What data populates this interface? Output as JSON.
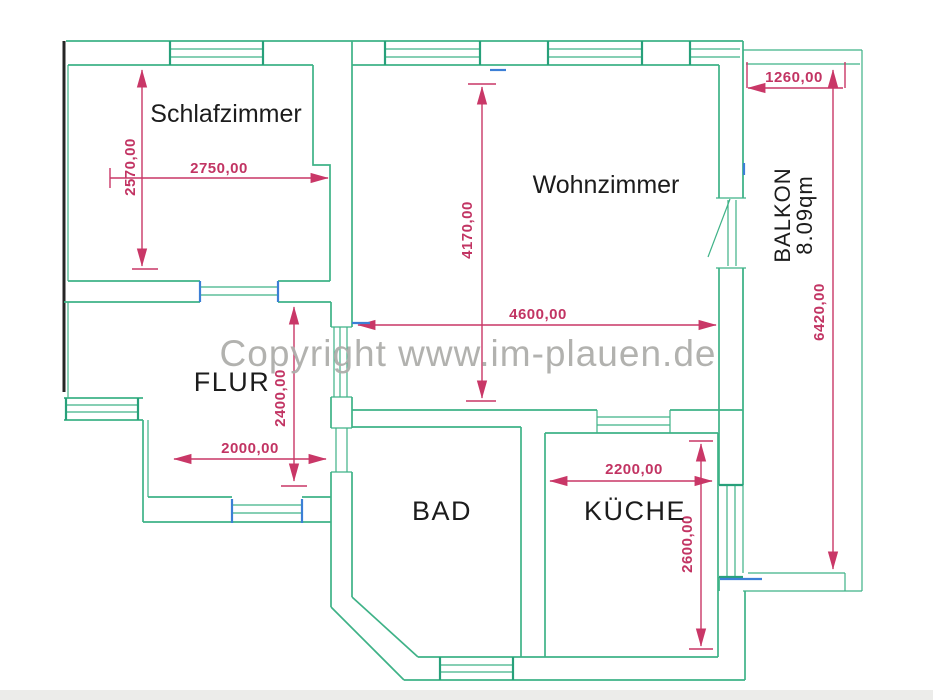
{
  "watermark": "Copyright www.im-plauen.de",
  "rooms": {
    "schlafzimmer": {
      "label": "Schlafzimmer",
      "width": "2750,00",
      "depth": "2570,00"
    },
    "wohnzimmer": {
      "label": "Wohnzimmer",
      "width": "4600,00",
      "depth": "4170,00"
    },
    "flur": {
      "label": "FLUR",
      "width": "2000,00",
      "depth": "2400,00"
    },
    "bad": {
      "label": "BAD"
    },
    "kueche": {
      "label": "KÜCHE",
      "width": "2200,00",
      "depth": "2600,00"
    },
    "balkon": {
      "label": "BALKON",
      "area": "8.09qm",
      "width": "1260,00",
      "depth": "6420,00"
    }
  },
  "colors": {
    "wall_green": "#3eb287",
    "dimension_magenta": "#c93767",
    "label_black": "#1c1c1c",
    "watermark_gray": "#aeaeab",
    "marker_blue": "#3c7fd6"
  }
}
